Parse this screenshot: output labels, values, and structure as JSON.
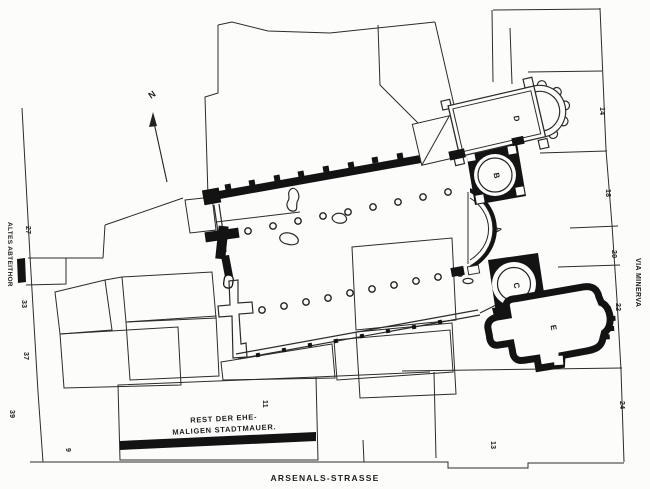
{
  "plan": {
    "title": "Abbey church excavation plan",
    "north_label": "N",
    "streets": {
      "left": "ALTES ABTEITHOR",
      "right": "VIA MINERVA",
      "bottom": "ARSENALS-STRASSE"
    },
    "caption": {
      "line1": "REST DER EHE-",
      "line2": "MALIGEN STADTMAUER."
    },
    "building_labels": [
      "A",
      "B",
      "C",
      "D",
      "E"
    ],
    "house_numbers": {
      "left": [
        "27",
        "33",
        "37",
        "39"
      ],
      "right": [
        "14",
        "18",
        "20",
        "22",
        "24"
      ],
      "bottom": [
        "9",
        "11",
        "13"
      ]
    },
    "colors": {
      "ink": "#1d1d1d",
      "wall_black": "#131313",
      "paper": "#fcfcfb"
    }
  }
}
